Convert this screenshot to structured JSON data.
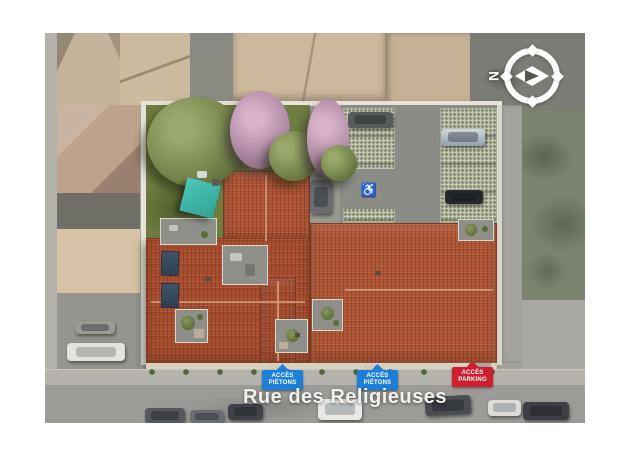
{
  "street_label": {
    "text": "Rue des Religieuses"
  },
  "compass": {
    "north_label": "N"
  },
  "access_badges": [
    {
      "name": "acces-pietons-1",
      "line1": "ACCÈS",
      "line2": "PIÉTONS",
      "color": "#1e7fd8"
    },
    {
      "name": "acces-pietons-2",
      "line1": "ACCÈS",
      "line2": "PIÉTONS",
      "color": "#1e7fd8"
    },
    {
      "name": "acces-parking",
      "line1": "ACCÈS",
      "line2": "PARKING",
      "color": "#cf1f2e"
    }
  ],
  "symbols": {
    "handicap_parking_icon": "♿"
  },
  "colors": {
    "badge_blue": "#1e7fd8",
    "badge_red": "#cf1f2e",
    "roof_terracotta": "#b05535",
    "lawn_green": "#6e7c40",
    "shade_sail_teal": "#3db4a6",
    "asphalt_grey": "#9c9b97"
  }
}
